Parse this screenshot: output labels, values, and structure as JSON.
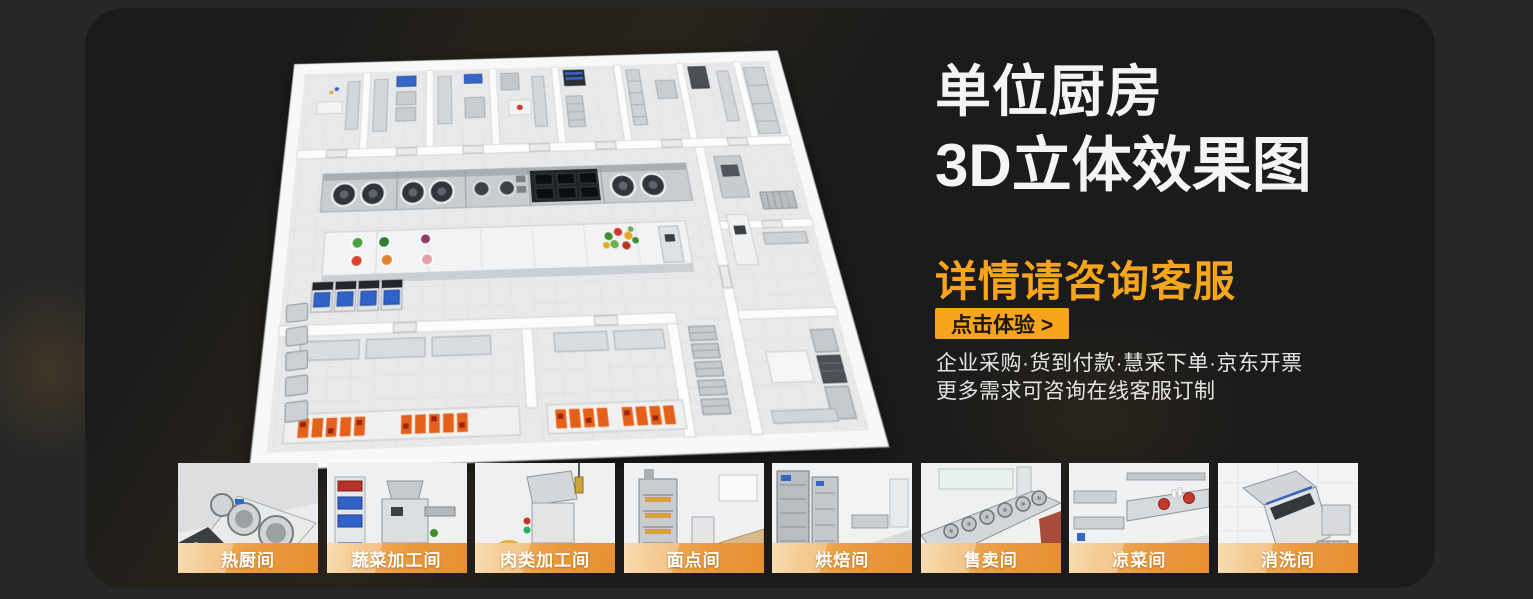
{
  "colors": {
    "page_bg": "#272727",
    "card_bg": "#1b1b1b",
    "accent_orange": "#f7a51d",
    "label_gradient_start": "#f4cd8e",
    "label_gradient_end": "#e78e32",
    "title_white": "#f4f4f4"
  },
  "hero": {
    "title_line1": "单位厨房",
    "title_line2": "3D立体效果图",
    "subtitle": "详情请咨询客服",
    "cta_label": "点击体验 >",
    "desc_line1": "企业采购·货到付款·慧采下单·京东开票",
    "desc_line2": "更多需求可咨询在线客服订制"
  },
  "floorplan": {
    "description": "3d-isometric-commercial-kitchen-floorplan-render"
  },
  "thumbnails": [
    {
      "label": "热厨间"
    },
    {
      "label": "蔬菜加工间"
    },
    {
      "label": "肉类加工间"
    },
    {
      "label": "面点间"
    },
    {
      "label": "烘焙间"
    },
    {
      "label": "售卖间"
    },
    {
      "label": "凉菜间"
    },
    {
      "label": "消洗间"
    }
  ]
}
